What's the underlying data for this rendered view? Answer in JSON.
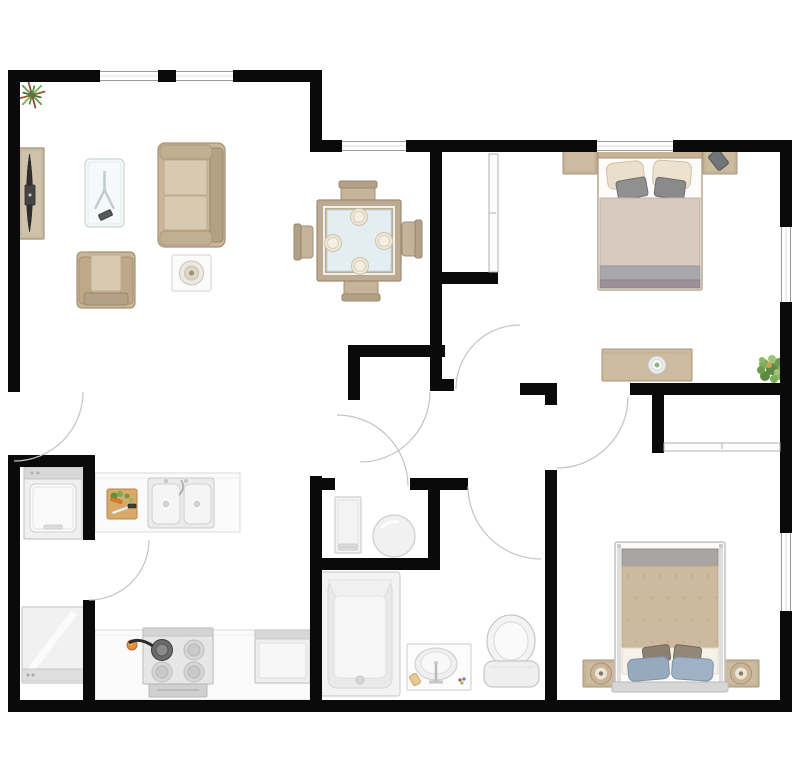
{
  "title": "two-bedroom-apartment-floor-plan",
  "canvas": {
    "w": 800,
    "h": 772,
    "bg": "#ffffff",
    "wall_color": "#0a0a0a",
    "arc_color": "#c3c3c3",
    "window_line": "#9a9a9a"
  },
  "rooms": [
    {
      "name": "living-room"
    },
    {
      "name": "dining-area"
    },
    {
      "name": "kitchen"
    },
    {
      "name": "entry-hall"
    },
    {
      "name": "hallway"
    },
    {
      "name": "utility-closet"
    },
    {
      "name": "bathroom"
    },
    {
      "name": "bedroom-1"
    },
    {
      "name": "bedroom-2"
    },
    {
      "name": "coat-closet"
    },
    {
      "name": "bedroom-1-closet"
    },
    {
      "name": "bedroom-2-closet"
    }
  ],
  "walls": [
    {
      "x": 8,
      "y": 70,
      "w": 310,
      "h": 12
    },
    {
      "x": 310,
      "y": 70,
      "w": 12,
      "h": 82
    },
    {
      "x": 310,
      "y": 140,
      "w": 482,
      "h": 12
    },
    {
      "x": 780,
      "y": 140,
      "w": 12,
      "h": 572
    },
    {
      "x": 8,
      "y": 700,
      "w": 784,
      "h": 12
    },
    {
      "x": 8,
      "y": 70,
      "w": 12,
      "h": 322
    },
    {
      "x": 8,
      "y": 461,
      "w": 12,
      "h": 251
    },
    {
      "x": 8,
      "y": 455,
      "w": 87,
      "h": 12
    },
    {
      "x": 83,
      "y": 455,
      "w": 12,
      "h": 85
    },
    {
      "x": 83,
      "y": 600,
      "w": 12,
      "h": 112
    },
    {
      "x": 310,
      "y": 476,
      "w": 12,
      "h": 236
    },
    {
      "x": 430,
      "y": 152,
      "w": 12,
      "h": 239
    },
    {
      "x": 442,
      "y": 272,
      "w": 56,
      "h": 12
    },
    {
      "x": 348,
      "y": 345,
      "w": 97,
      "h": 12
    },
    {
      "x": 348,
      "y": 345,
      "w": 12,
      "h": 55
    },
    {
      "x": 520,
      "y": 383,
      "w": 37,
      "h": 12
    },
    {
      "x": 545,
      "y": 395,
      "w": 12,
      "h": 10
    },
    {
      "x": 630,
      "y": 383,
      "w": 162,
      "h": 12
    },
    {
      "x": 652,
      "y": 395,
      "w": 12,
      "h": 58
    },
    {
      "x": 545,
      "y": 470,
      "w": 12,
      "h": 242
    },
    {
      "x": 310,
      "y": 478,
      "w": 25,
      "h": 12
    },
    {
      "x": 410,
      "y": 478,
      "w": 58,
      "h": 12
    },
    {
      "x": 428,
      "y": 478,
      "w": 12,
      "h": 92
    },
    {
      "x": 310,
      "y": 558,
      "w": 130,
      "h": 12
    },
    {
      "x": 442,
      "y": 379,
      "w": 12,
      "h": 12
    }
  ],
  "windows": [
    {
      "name": "living-window-1",
      "x": 100,
      "y": 70,
      "w": 58,
      "h": 12,
      "o": "h"
    },
    {
      "name": "living-window-2",
      "x": 176,
      "y": 70,
      "w": 57,
      "h": 12,
      "o": "h"
    },
    {
      "name": "dining-window",
      "x": 342,
      "y": 140,
      "w": 64,
      "h": 12,
      "o": "h"
    },
    {
      "name": "bedroom-1-top-window",
      "x": 597,
      "y": 140,
      "w": 76,
      "h": 12,
      "o": "h"
    },
    {
      "name": "bedroom-1-side-window",
      "x": 780,
      "y": 227,
      "w": 12,
      "h": 75,
      "o": "v"
    },
    {
      "name": "bedroom-2-side-window",
      "x": 780,
      "y": 533,
      "w": 12,
      "h": 78,
      "o": "v"
    }
  ],
  "closet_doors": [
    {
      "name": "bedroom-1-closet-door",
      "x": 489,
      "y": 154,
      "w": 9,
      "h": 118,
      "o": "v"
    },
    {
      "name": "bedroom-2-closet-door",
      "x": 664,
      "y": 443,
      "w": 116,
      "h": 8,
      "o": "h"
    }
  ],
  "door_arcs": [
    {
      "name": "entry-door-arc",
      "d": "M 83 392 A 69 69 0 0 1 14 461"
    },
    {
      "name": "kitchen-door-arc",
      "d": "M 149 540 A 60 60 0 0 1 89 600"
    },
    {
      "name": "coat-closet-door-arc",
      "d": "M 430 392 A 70 70 0 0 1 360 462"
    },
    {
      "name": "bedroom-1-door-arc",
      "d": "M 456 389 A 64 64 0 0 1 520 325"
    },
    {
      "name": "bedroom-2-door-arc",
      "d": "M 628 397 A 71 71 0 0 1 557 468"
    },
    {
      "name": "utility-door-arc",
      "d": "M 408 486 A 71 71 0 0 0 337 415"
    },
    {
      "name": "bathroom-door-arc",
      "d": "M 468 486 A 73 73 0 0 0 541 559"
    }
  ],
  "furniture": [
    {
      "name": "potted-plant-living",
      "kind": "plant-spiky",
      "x": 18,
      "y": 80,
      "w": 28,
      "h": 30
    },
    {
      "name": "tv-console",
      "kind": "tv-console",
      "x": 19,
      "y": 148,
      "w": 25,
      "h": 91
    },
    {
      "name": "coffee-table",
      "kind": "coffee-table",
      "x": 85,
      "y": 159,
      "w": 39,
      "h": 68
    },
    {
      "name": "sofa",
      "kind": "sofa",
      "x": 158,
      "y": 143,
      "w": 67,
      "h": 104
    },
    {
      "name": "armchair",
      "kind": "armchair",
      "x": 77,
      "y": 252,
      "w": 58,
      "h": 56
    },
    {
      "name": "side-table-lamp",
      "kind": "side-table",
      "x": 172,
      "y": 255,
      "w": 39,
      "h": 36
    },
    {
      "name": "dining-chair-top",
      "kind": "dining-chair",
      "side": "top",
      "x": 341,
      "y": 181,
      "w": 34,
      "h": 20
    },
    {
      "name": "dining-chair-bottom",
      "kind": "dining-chair",
      "side": "bottom",
      "x": 344,
      "y": 280,
      "w": 34,
      "h": 21
    },
    {
      "name": "dining-chair-left",
      "kind": "dining-chair",
      "side": "left",
      "x": 294,
      "y": 226,
      "w": 19,
      "h": 32
    },
    {
      "name": "dining-chair-right",
      "kind": "dining-chair",
      "side": "right",
      "x": 402,
      "y": 222,
      "w": 20,
      "h": 34
    },
    {
      "name": "dining-table",
      "kind": "dining-table",
      "x": 317,
      "y": 200,
      "w": 84,
      "h": 81,
      "plates": [
        [
          359,
          217
        ],
        [
          333,
          243
        ],
        [
          384,
          241
        ],
        [
          360,
          266
        ]
      ]
    },
    {
      "name": "nightstand-bedroom1-left",
      "kind": "nightstand",
      "x": 563,
      "y": 148,
      "w": 34,
      "h": 26
    },
    {
      "name": "nightstand-bedroom1-right",
      "kind": "nightstand",
      "x": 703,
      "y": 148,
      "w": 34,
      "h": 26,
      "phone": true
    },
    {
      "name": "bed-bedroom-1",
      "kind": "bed-top",
      "x": 598,
      "y": 146,
      "w": 104,
      "h": 144
    },
    {
      "name": "dresser-bedroom-1",
      "kind": "dresser",
      "x": 602,
      "y": 349,
      "w": 90,
      "h": 32
    },
    {
      "name": "potted-plant-bedroom-1",
      "kind": "plant-bushy",
      "x": 756,
      "y": 352,
      "w": 32,
      "h": 34
    },
    {
      "name": "nightstand-bedroom2-left",
      "kind": "nightstand",
      "x": 583,
      "y": 660,
      "w": 36,
      "h": 27,
      "lamp": true
    },
    {
      "name": "nightstand-bedroom2-right",
      "kind": "nightstand",
      "x": 723,
      "y": 660,
      "w": 36,
      "h": 27,
      "lamp": true
    },
    {
      "name": "bed-bedroom-2",
      "kind": "bed-bottom",
      "x": 615,
      "y": 542,
      "w": 110,
      "h": 148
    },
    {
      "name": "washing-machine",
      "kind": "washer",
      "x": 24,
      "y": 467,
      "w": 58,
      "h": 72
    },
    {
      "name": "refrigerator",
      "kind": "fridge",
      "x": 22,
      "y": 607,
      "w": 62,
      "h": 76
    },
    {
      "name": "kitchen-counter-sink",
      "kind": "counter",
      "x": 95,
      "y": 473,
      "w": 145,
      "h": 59
    },
    {
      "name": "kitchen-sink",
      "kind": "sink2",
      "x": 148,
      "y": 478,
      "w": 66,
      "h": 50
    },
    {
      "name": "cutting-board",
      "kind": "board",
      "x": 107,
      "y": 489,
      "w": 30,
      "h": 30
    },
    {
      "name": "kitchen-counter-lower",
      "kind": "counter",
      "x": 95,
      "y": 630,
      "w": 215,
      "h": 70
    },
    {
      "name": "fruit",
      "kind": "fruit",
      "x": 127,
      "y": 640,
      "w": 10,
      "h": 10
    },
    {
      "name": "stove",
      "kind": "stove",
      "x": 143,
      "y": 628,
      "w": 70,
      "h": 56
    },
    {
      "name": "dishwasher",
      "kind": "dishwasher",
      "x": 255,
      "y": 630,
      "w": 55,
      "h": 53
    },
    {
      "name": "utility-cabinet",
      "kind": "cabinet",
      "x": 335,
      "y": 497,
      "w": 26,
      "h": 56
    },
    {
      "name": "water-heater",
      "kind": "heater",
      "x": 373,
      "y": 515,
      "w": 42,
      "h": 42
    },
    {
      "name": "bathtub",
      "kind": "tub",
      "x": 320,
      "y": 572,
      "w": 80,
      "h": 124
    },
    {
      "name": "bathroom-vanity",
      "kind": "vanity",
      "x": 407,
      "y": 644,
      "w": 64,
      "h": 46
    },
    {
      "name": "toilet",
      "kind": "toilet",
      "x": 484,
      "y": 615,
      "w": 55,
      "h": 72
    }
  ]
}
